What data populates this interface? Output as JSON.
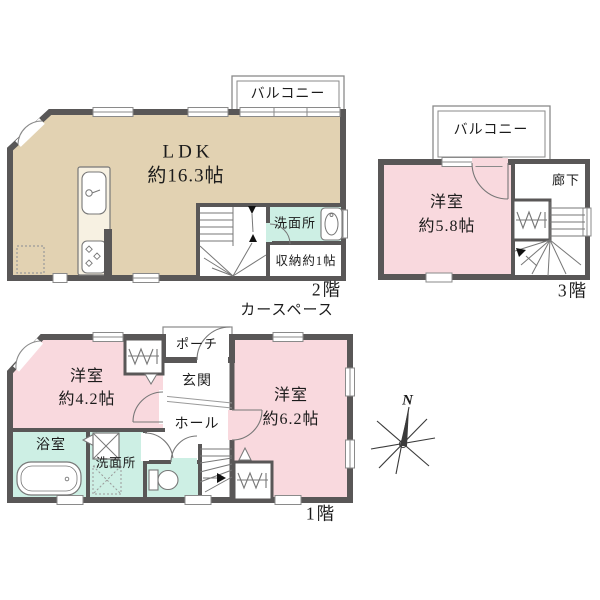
{
  "floor2": {
    "floor_label": "2階",
    "balcony_label": "バルコニー",
    "ldk_name": "LDK",
    "ldk_size": "約16.3帖",
    "washroom_label": "洗面所",
    "storage_label": "収納約1帖"
  },
  "floor3": {
    "floor_label": "3階",
    "balcony_label": "バルコニー",
    "room_name": "洋室",
    "room_size": "約5.8帖",
    "corridor_label": "廊下"
  },
  "floor1": {
    "floor_label": "1階",
    "car_space_label": "カースペース",
    "porch_label": "ポーチ",
    "entrance_label": "玄関",
    "hall_label": "ホール",
    "bedroom_west_name": "洋室",
    "bedroom_west_size": "約4.2帖",
    "bedroom_east_name": "洋室",
    "bedroom_east_size": "約6.2帖",
    "bathroom_label": "浴室",
    "washroom_label": "洗面所"
  },
  "compass": {
    "north_label": "N"
  },
  "colors": {
    "wall": "#595757",
    "ldk_fill": "#E2D2B2",
    "bedroom_fill": "#F9D9DE",
    "wet_area_fill": "#CDEFE4",
    "thin_line": "#8a8a8a"
  }
}
